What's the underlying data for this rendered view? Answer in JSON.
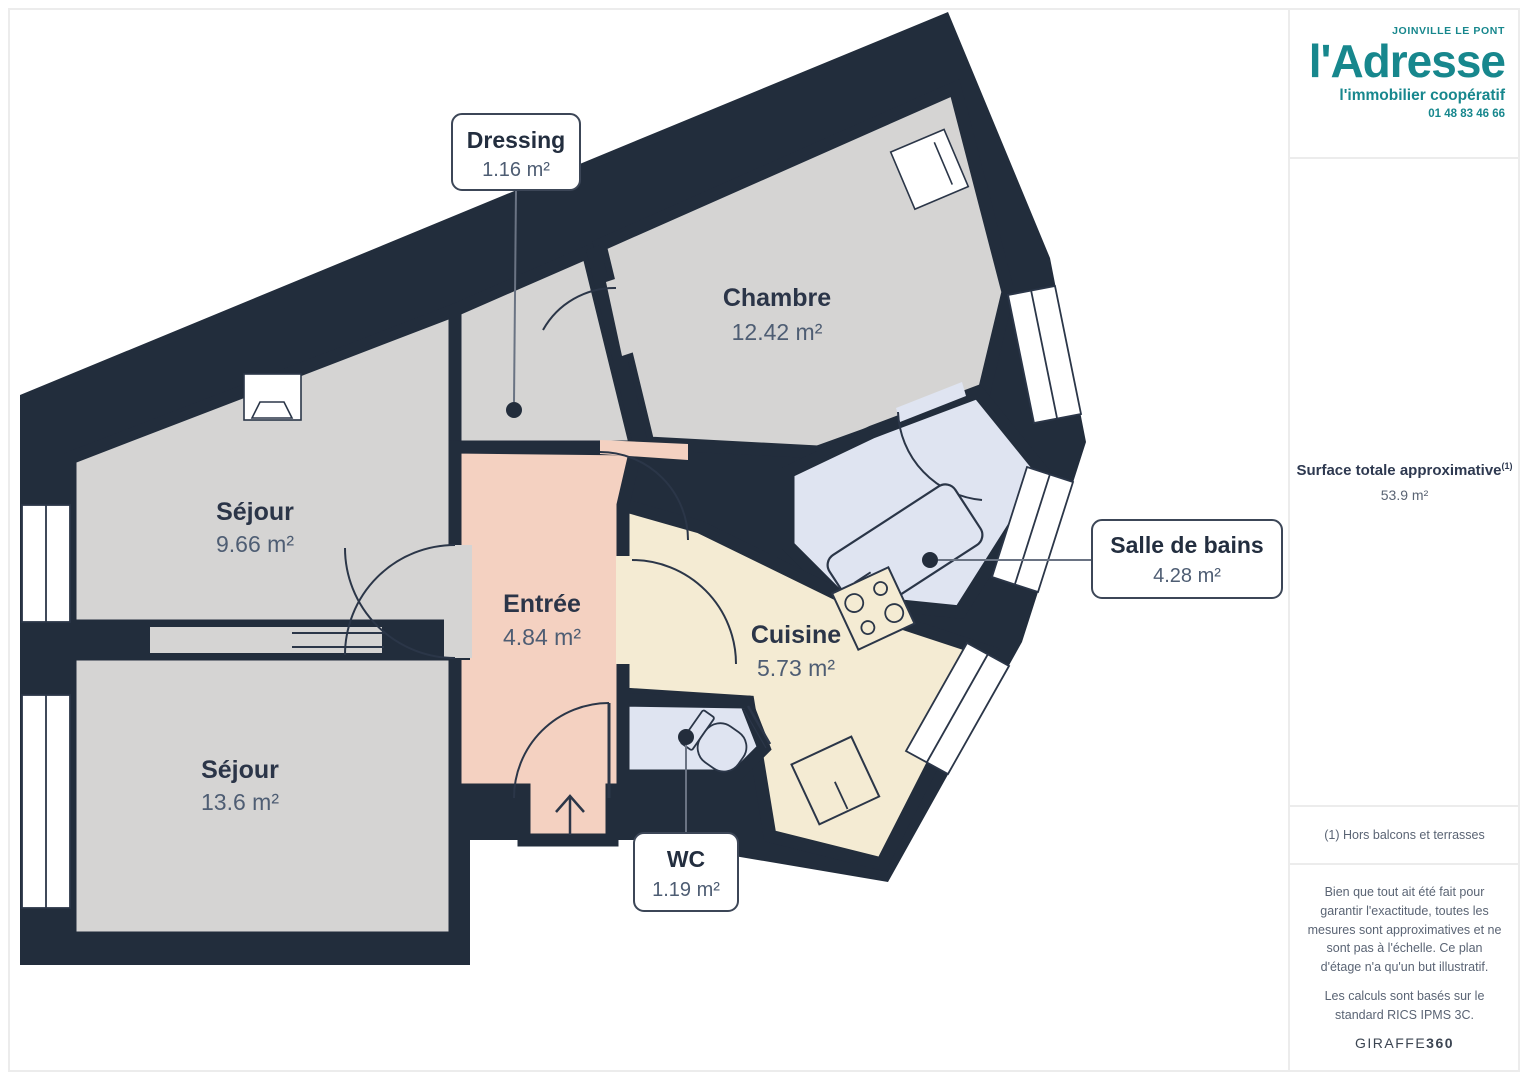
{
  "sidebar": {
    "logo": {
      "location": "JOINVILLE LE PONT",
      "name": "l'Adresse",
      "tagline": "l'immobilier coopératif",
      "phone": "01 48 83 46 66"
    },
    "surface": {
      "label": "Surface totale approximative",
      "note_ref": "(1)",
      "value": "53.9 m²"
    },
    "footnote": "(1) Hors balcons et terrasses",
    "disclaimer_1": "Bien que tout ait été fait pour garantir l'exactitude, toutes les mesures sont approximatives et ne sont pas à l'échelle. Ce plan d'étage n'a qu'un but illustratif.",
    "disclaimer_2": "Les calculs sont basés sur le standard RICS IPMS 3C.",
    "watermark_brand": "GIRAFFE",
    "watermark_suffix": "360"
  },
  "floorplan": {
    "rooms": {
      "sejour_haut": {
        "name": "Séjour",
        "area": "9.66 m²"
      },
      "sejour_bas": {
        "name": "Séjour",
        "area": "13.6 m²"
      },
      "entree": {
        "name": "Entrée",
        "area": "4.84 m²"
      },
      "chambre": {
        "name": "Chambre",
        "area": "12.42 m²"
      },
      "cuisine": {
        "name": "Cuisine",
        "area": "5.73 m²"
      },
      "dressing": {
        "name": "Dressing",
        "area": "1.16 m²"
      },
      "salle_de_bains": {
        "name": "Salle de bains",
        "area": "4.28 m²"
      },
      "wc": {
        "name": "WC",
        "area": "1.19 m²"
      }
    },
    "colors": {
      "wall": "#222d3c",
      "room_gray": "#d5d4d3",
      "room_salmon": "#f4d1c1",
      "room_cream": "#f4ebd3",
      "room_blue": "#dfe4f1",
      "brand_teal": "#17878d"
    }
  }
}
